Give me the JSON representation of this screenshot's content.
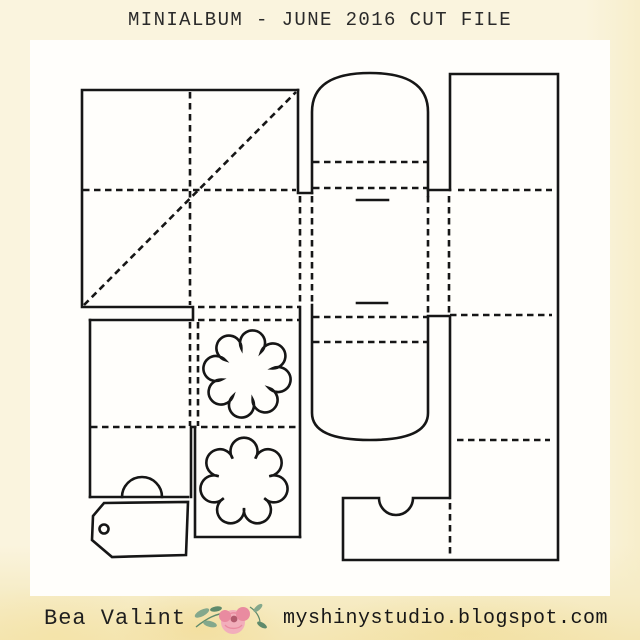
{
  "title": "MINIALBUM - JUNE 2016 CUT FILE",
  "footer": {
    "author": "Bea Valint",
    "site": "myshinystudio.blogspot.com",
    "flower_icon": "watercolor-rose"
  },
  "colors": {
    "background_cream": "#faf4de",
    "background_band": "#f4e6b4",
    "panel_white": "#fffefb",
    "line_black": "#161616",
    "text_dark": "#2a2a2a",
    "rose_light": "#f2aebb",
    "rose_mid": "#e98ba0",
    "rose_deep": "#b25a6d",
    "leaf_green": "#84a88c",
    "leaf_dark": "#5f8a6b"
  },
  "cutfile": {
    "description": "mini album cut and fold template: base square with diagonal folds, pocket column, flower dies, arched spine wrap with slots, folding right panel strip, thumb-notch pocket and gift tag",
    "solid_lines": [
      {
        "name": "album-base-outline",
        "d": "M298,90 H82 V307 H193 V320 H90"
      },
      {
        "name": "album-base-right-edge",
        "d": "M298,90 V193 H312"
      },
      {
        "name": "left-pocket-left-edge",
        "d": "M90,320 V497"
      },
      {
        "name": "left-flap-right-edge",
        "d": "M191,427 V497"
      },
      {
        "name": "left-flap-bottom-edge",
        "d": "M90,497 H188"
      },
      {
        "name": "left-flap-thumb-tab",
        "d": "M122,497 A20,20 0 0 1 162,497"
      },
      {
        "name": "flower-pocket-outline",
        "d": "M195,427 V537 H300"
      },
      {
        "name": "flower-pocket-right-edge",
        "d": "M300,307 V537"
      },
      {
        "name": "spine-top-arch",
        "d": "M312,193 V112 C312,84 334,73 370,73 C406,73 428,84 428,112 V196"
      },
      {
        "name": "spine-bottom-arch",
        "d": "M312,305 V413 C312,432 334,440 370,440 C406,440 428,432 428,413 V317"
      },
      {
        "name": "spine-slot-upper",
        "d": "M357,200 H388"
      },
      {
        "name": "spine-slot-lower",
        "d": "M357,303 H387"
      },
      {
        "name": "spine-step-upper",
        "d": "M428,190 H450"
      },
      {
        "name": "spine-step-lower",
        "d": "M428,316 H449"
      },
      {
        "name": "right-panel-outline",
        "d": "M450,190 V74 H558 V560 H343 V498 H379 A17,17 0 0 0 413,498 H449"
      },
      {
        "name": "right-panel-left-edge",
        "d": "M450,317 V498"
      },
      {
        "name": "tag-outline",
        "d": "M104,503 L188,502 L186,555 L112,557 L92,540 L93,516 Z"
      }
    ],
    "fold_lines": [
      {
        "name": "base-vertical-fold",
        "d": "M190,92 V305"
      },
      {
        "name": "base-horizontal-fold",
        "d": "M83,190 H296"
      },
      {
        "name": "base-diagonal-fold",
        "d": "M84,305 L296,92"
      },
      {
        "name": "left-hinge-fold-a",
        "d": "M300,196 V305"
      },
      {
        "name": "left-hinge-fold-b",
        "d": "M312,196 V305"
      },
      {
        "name": "flower-pocket-top-fold",
        "d": "M198,307 H300"
      },
      {
        "name": "flower-pocket-second-fold",
        "d": "M198,320 H300"
      },
      {
        "name": "pocket-gap-fold-a",
        "d": "M190,322 V426"
      },
      {
        "name": "pocket-gap-fold-b",
        "d": "M198,322 V426"
      },
      {
        "name": "pockets-bottom-fold",
        "d": "M91,427 H298"
      },
      {
        "name": "spine-upper-fold-a",
        "d": "M313,162 H427"
      },
      {
        "name": "spine-upper-fold-b",
        "d": "M313,188 H427"
      },
      {
        "name": "spine-lower-fold-a",
        "d": "M313,317 H427"
      },
      {
        "name": "spine-lower-fold-b",
        "d": "M313,342 H427"
      },
      {
        "name": "right-hinge-fold-a",
        "d": "M428,196 V313"
      },
      {
        "name": "right-hinge-fold-b",
        "d": "M449,196 V313"
      },
      {
        "name": "right-panel-fold-1",
        "d": "M458,190 H552"
      },
      {
        "name": "right-panel-fold-2",
        "d": "M450,315 H552"
      },
      {
        "name": "right-panel-fold-3",
        "d": "M457,440 H550"
      },
      {
        "name": "right-panel-bottom-fold",
        "d": "M450,503 V557"
      }
    ],
    "flowers": [
      {
        "name": "flower-die-1",
        "cx": 247,
        "cy": 374,
        "petals": 8,
        "rn": 26,
        "rp": 12.5,
        "offset": -80
      },
      {
        "name": "flower-die-2",
        "cx": 244,
        "cy": 482,
        "petals": 7,
        "rn": 26,
        "rp": 13.5,
        "offset": -90
      }
    ],
    "holes": [
      {
        "name": "tag-hole",
        "cx": 104,
        "cy": 529,
        "r": 4.5
      }
    ]
  }
}
